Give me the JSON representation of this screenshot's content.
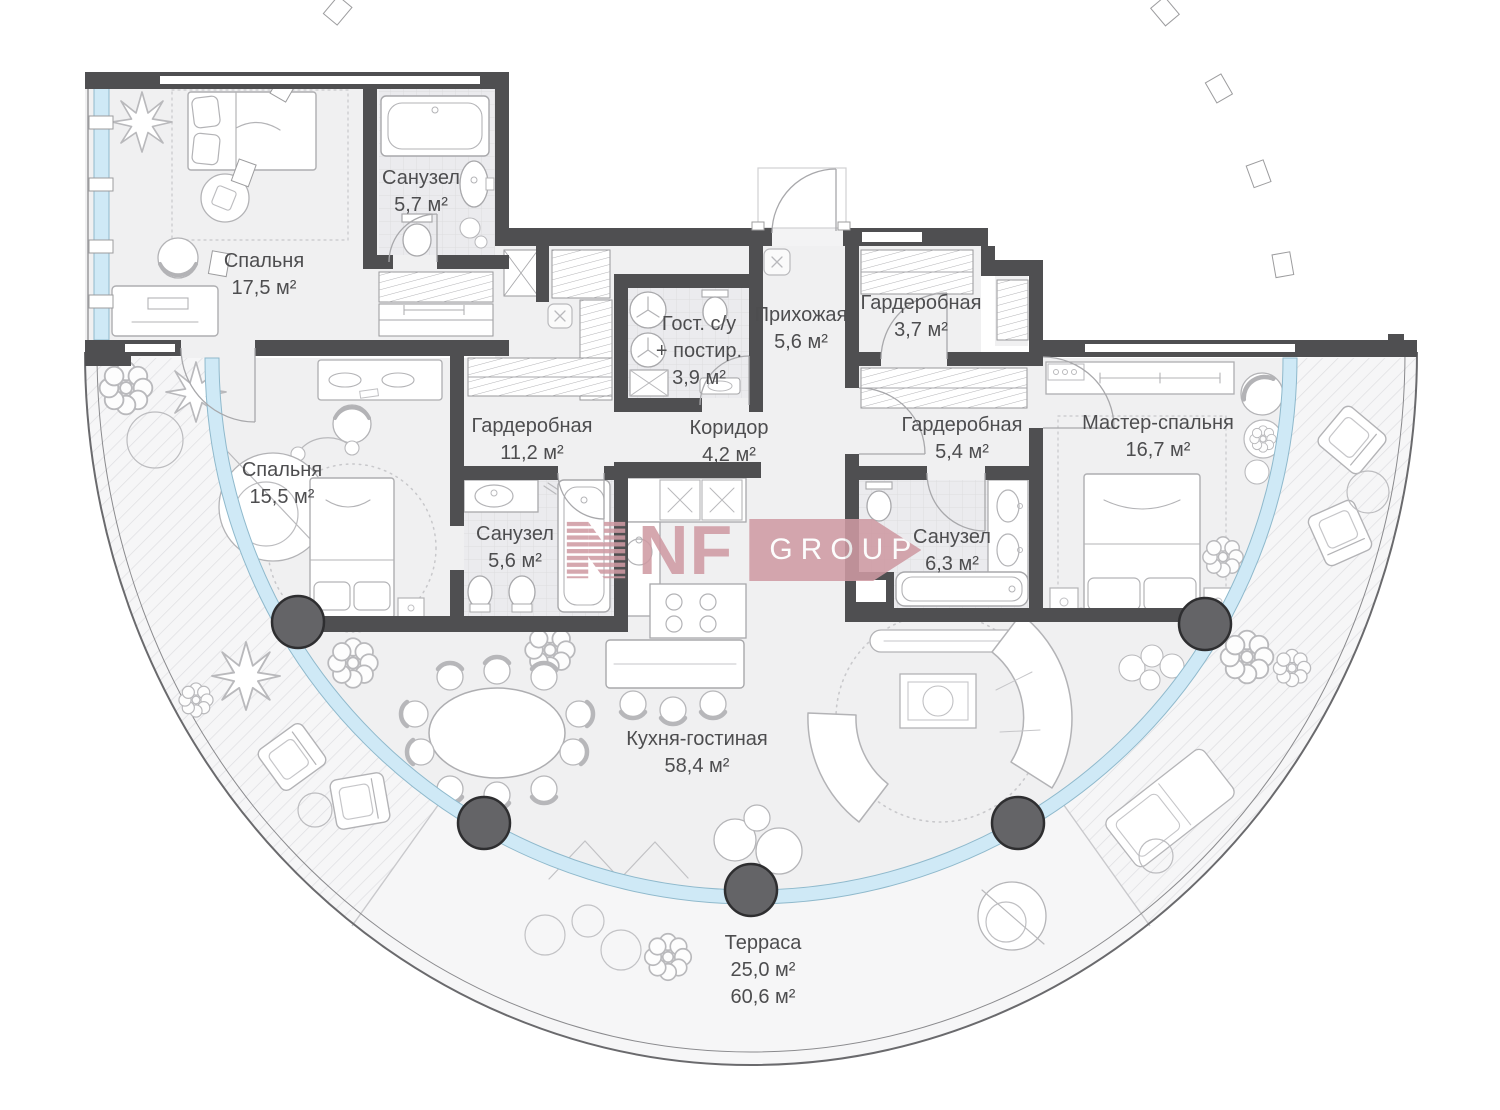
{
  "logo": {
    "nf": "NF",
    "group": "GROUP",
    "color": "#cf9aa3"
  },
  "rooms": [
    {
      "id": "bedroom-1",
      "label": "Спальня",
      "area": "17,5 м²"
    },
    {
      "id": "bathroom-1",
      "label": "Санузел",
      "area": "5,7 м²"
    },
    {
      "id": "guest-wc",
      "label": "Гост. с/у",
      "label2": "+ постир.",
      "area": "3,9 м²"
    },
    {
      "id": "hallway",
      "label": "Прихожая",
      "area": "5,6 м²"
    },
    {
      "id": "wardrobe-1",
      "label": "Гардеробная",
      "area": "3,7 м²"
    },
    {
      "id": "wardrobe-2",
      "label": "Гардеробная",
      "area": "11,2 м²"
    },
    {
      "id": "corridor",
      "label": "Коридор",
      "area": "4,2 м²"
    },
    {
      "id": "wardrobe-3",
      "label": "Гардеробная",
      "area": "5,4 м²"
    },
    {
      "id": "master-bedroom",
      "label": "Мастер-спальня",
      "area": "16,7 м²"
    },
    {
      "id": "bedroom-2",
      "label": "Спальня",
      "area": "15,5 м²"
    },
    {
      "id": "bathroom-2",
      "label": "Санузел",
      "area": "5,6 м²"
    },
    {
      "id": "bathroom-3",
      "label": "Санузел",
      "area": "6,3 м²"
    },
    {
      "id": "kitchen-living",
      "label": "Кухня-гостиная",
      "area": "58,4 м²"
    },
    {
      "id": "terrace",
      "label": "Терраса",
      "area": "25,0 м²",
      "area2": "60,6 м²"
    }
  ],
  "colors": {
    "wall": "#4f4f51",
    "glass": "#cfe9f6",
    "floor": "#f0f0f1",
    "terrace": "#f6f6f7",
    "hatch": "#dedee1",
    "text": "#4d4d4f",
    "logo_pink": "#cf9aa3"
  }
}
